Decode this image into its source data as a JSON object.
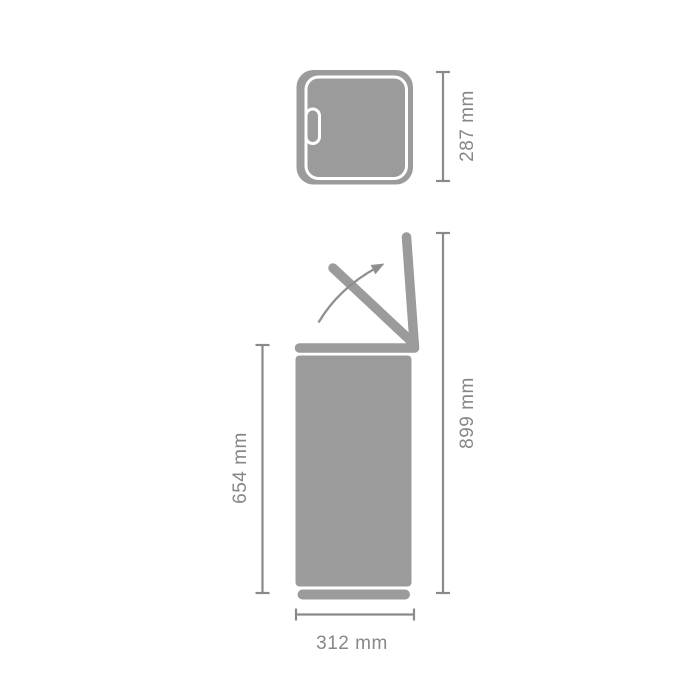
{
  "diagram": {
    "kind": "product-dimension-diagram",
    "views": [
      "top-view",
      "side-view-lid-open"
    ],
    "colors": {
      "bin_gray": "#9B9B9B",
      "dimension_gray": "#8A8A8A",
      "label_gray": "#878787",
      "arrow_gray": "#8F8F8F",
      "rim_white": "#FFFFFF",
      "background": "#FFFFFF"
    },
    "icons": {
      "lid_opening_arrow": "curved-arrow-up-right"
    },
    "dimensions": {
      "top_depth": {
        "label": "287 mm",
        "value": 287,
        "unit": "mm"
      },
      "total_height_open_lid": {
        "label": "899 mm",
        "value": 899,
        "unit": "mm"
      },
      "body_height": {
        "label": "654 mm",
        "value": 654,
        "unit": "mm"
      },
      "width": {
        "label": "312 mm",
        "value": 312,
        "unit": "mm"
      }
    }
  }
}
